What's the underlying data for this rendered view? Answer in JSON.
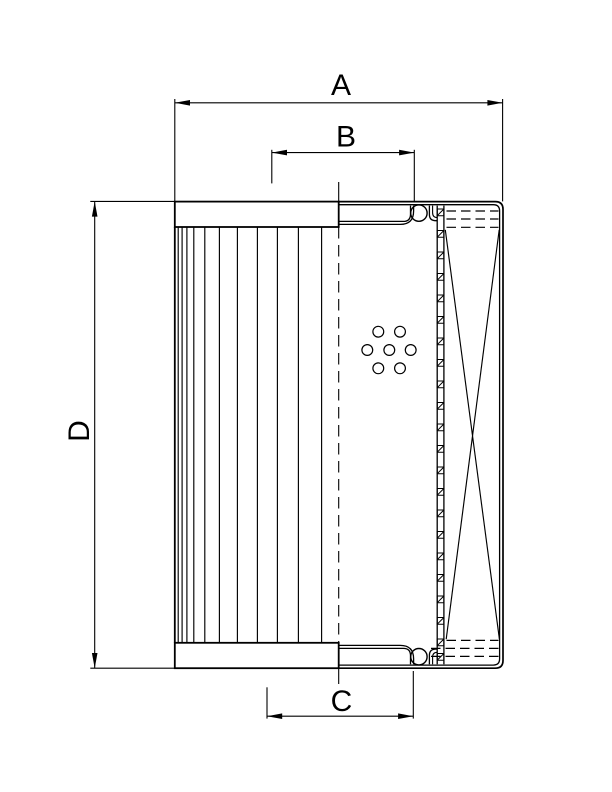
{
  "page": {
    "background_color": "#ffffff"
  },
  "drawing": {
    "type": "technical-drawing",
    "subject": "filter element half-section view",
    "line_color": "#000000",
    "labels": {
      "outer_diameter": "A",
      "top_inner_diameter": "B",
      "bottom_inner_diameter": "C",
      "height": "D"
    }
  }
}
